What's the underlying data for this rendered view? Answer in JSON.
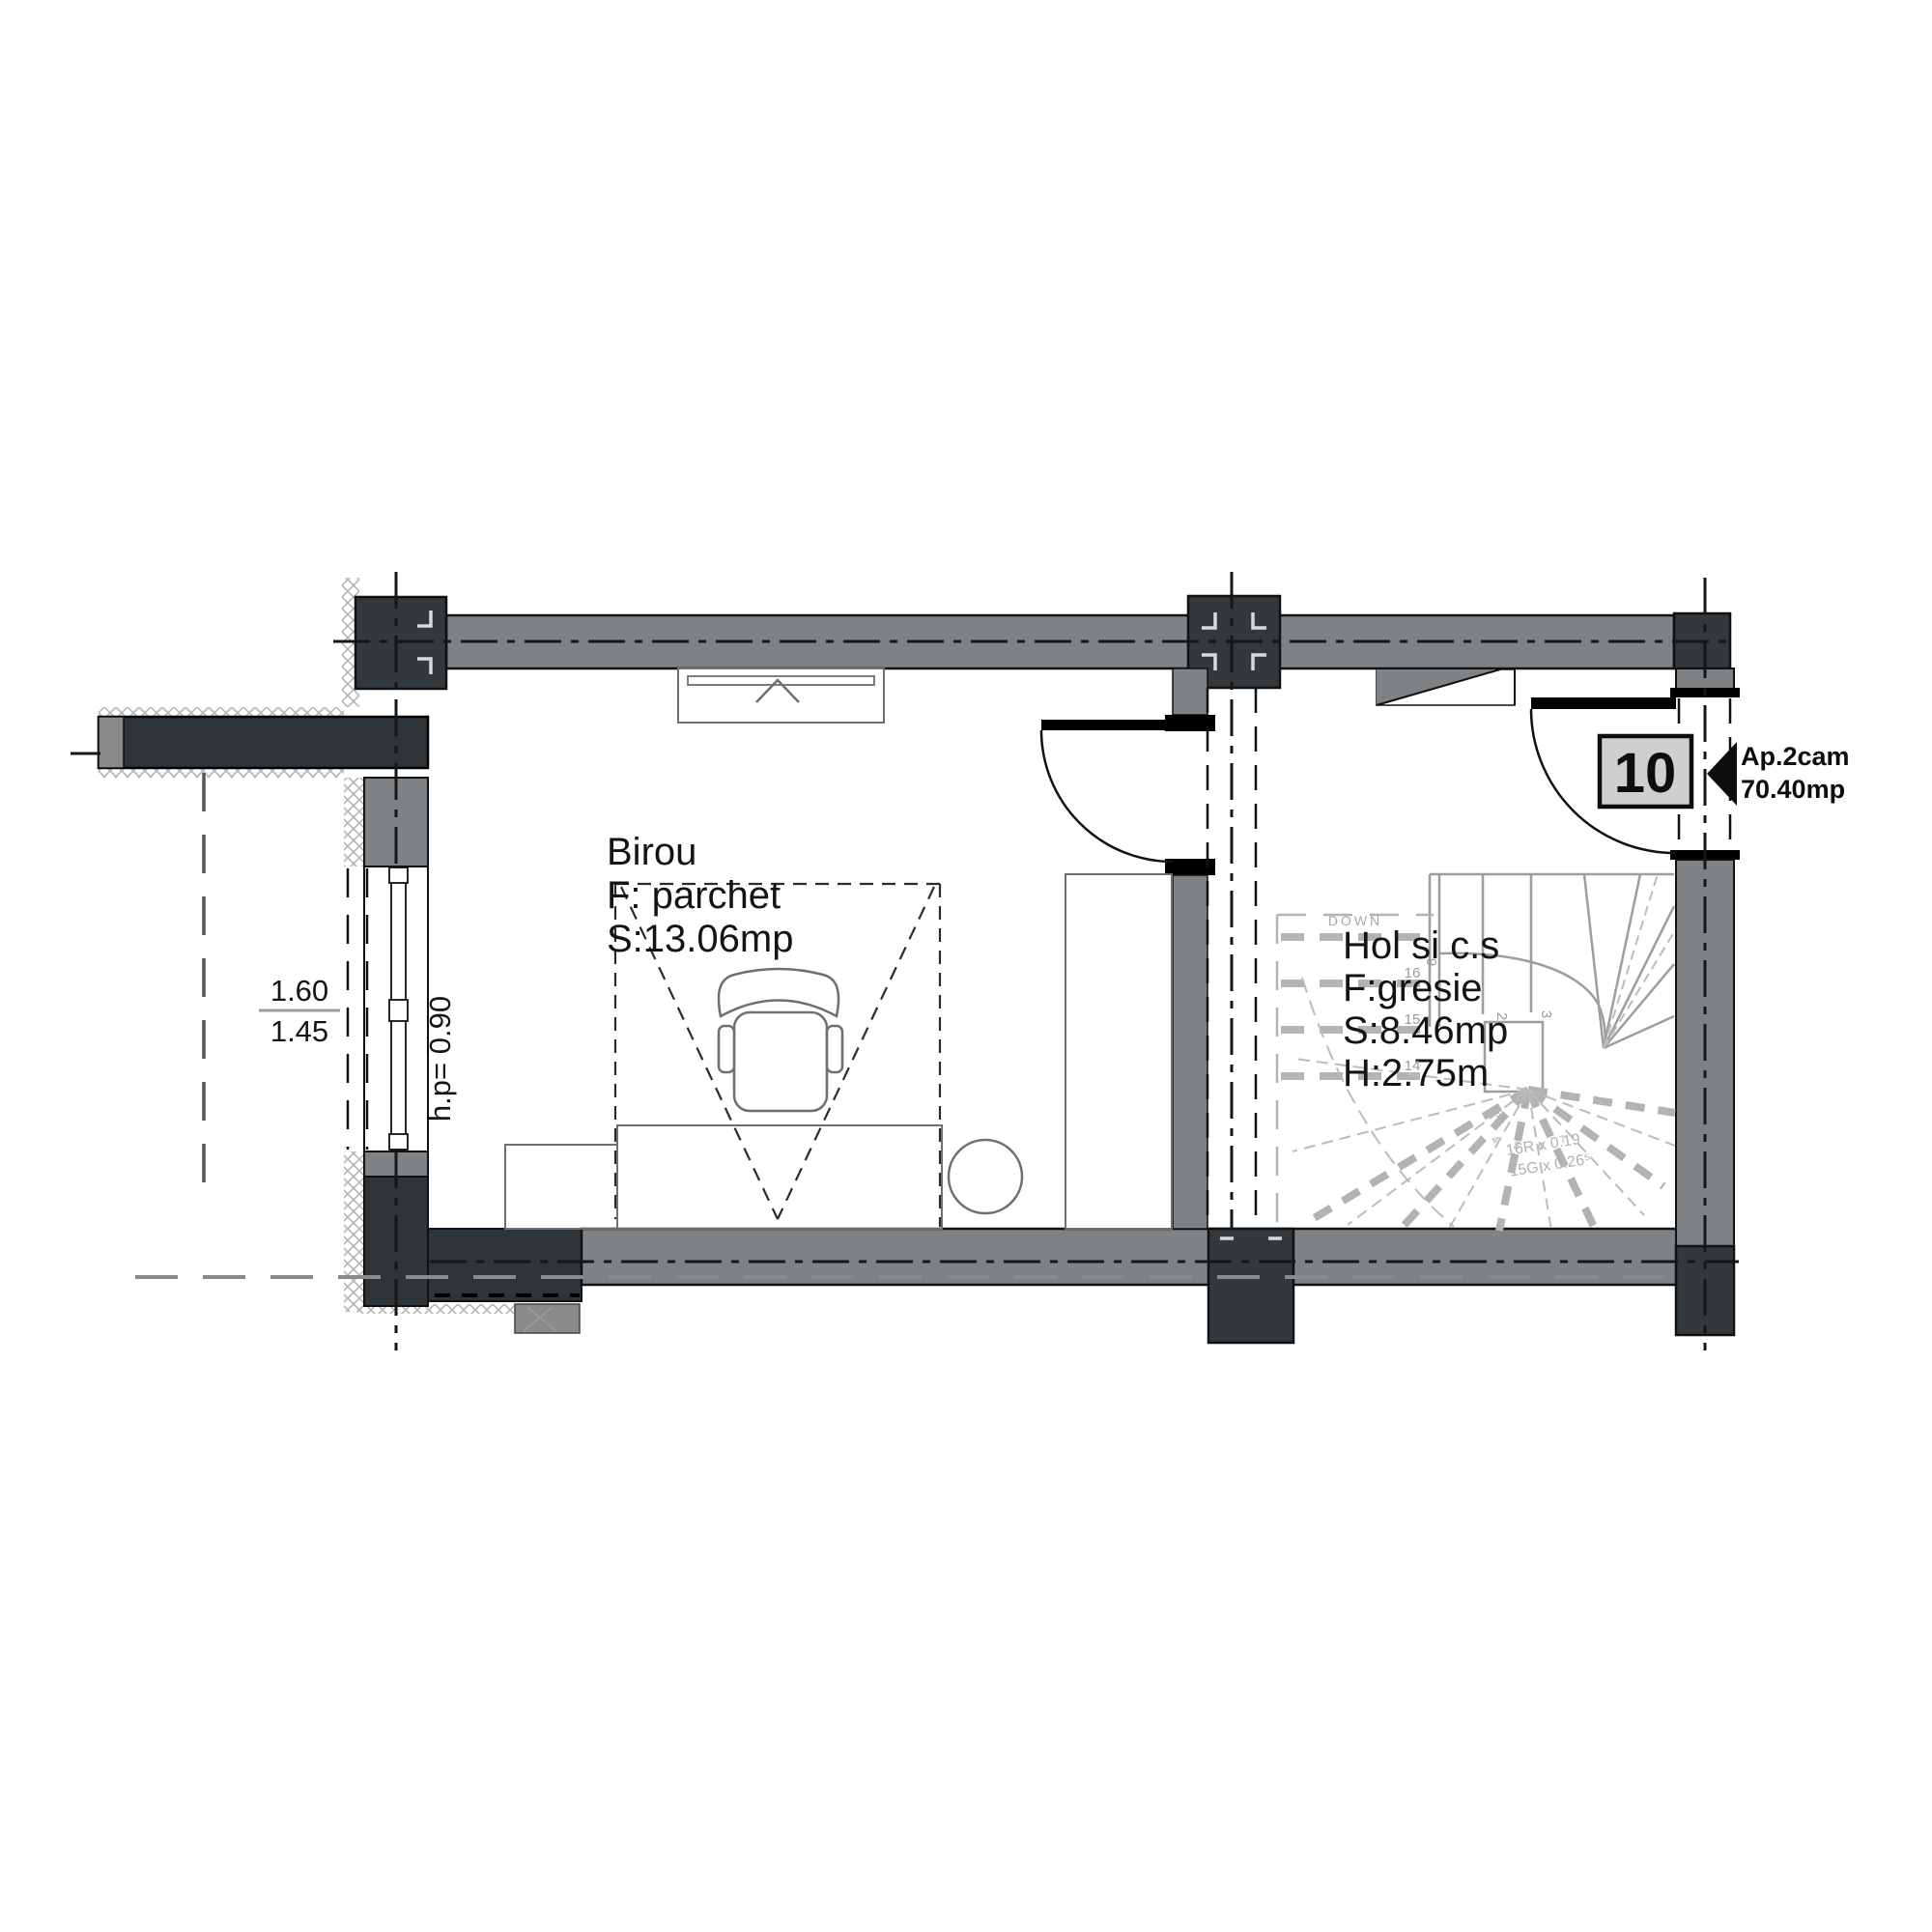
{
  "drawing": {
    "rooms": {
      "birou": {
        "name": "Birou",
        "floor": "F: parchet",
        "area": "S:13.06mp"
      },
      "hol": {
        "name": "Hol si c.s",
        "floor": "F:gresie",
        "area": "S:8.46mp",
        "height": "H:2.75m"
      }
    },
    "entry": {
      "door_number": "10",
      "apartment": "Ap.2cam",
      "apartment_area": "70.40mp"
    },
    "window": {
      "dim_top": "1.60",
      "dim_bottom": "1.45",
      "parapet": "h.p= 0.90"
    },
    "stair": {
      "direction": "DOWN",
      "note_risers": "16R x 0.19",
      "note_goings": "15G x 0.26⁵",
      "step_numbers": {
        "s16": "16",
        "s15": "15",
        "s14": "14",
        "s9": "9",
        "s2": "2",
        "s3": "3"
      },
      "pivot_digits": [
        "4",
        "5",
        "6",
        "7",
        "8"
      ]
    },
    "colors": {
      "wall_gray": "#7f8285",
      "wall_dark": "#33383c",
      "stair_gray": "#9e9e9e",
      "stair_light": "#b3b3b3",
      "door_box_fill": "#cfcfcf",
      "ink": "#111111"
    }
  }
}
